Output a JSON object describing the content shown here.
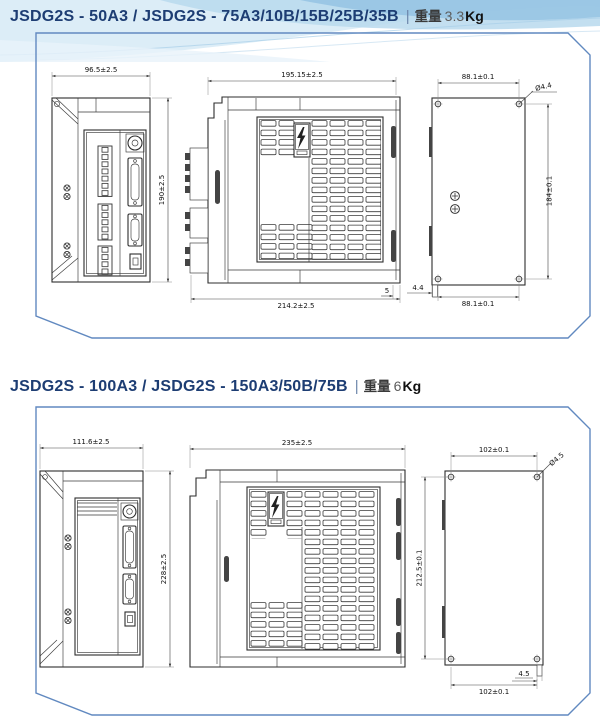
{
  "s1": {
    "title": "JSDG2S - 50A3 / JSDG2S - 75A3/10B/15B/25B/35B",
    "separator": "|",
    "weight_label": "重量",
    "weight_value": "3.3",
    "weight_unit": "Kg",
    "dims": {
      "front_width": "96.5±2.5",
      "front_height": "190±2.5",
      "side_width_top": "195.15±2.5",
      "side_width_bottom": "214.2±2.5",
      "side_edge_gap": "5",
      "back_pitch_top": "88.1±0.1",
      "back_hole_dia": "Ø4.4",
      "back_pitch_height": "184±0.1",
      "back_pitch_bottom": "88.1±0.1",
      "back_tab_width": "4.4"
    }
  },
  "s2": {
    "title": "JSDG2S - 100A3 / JSDG2S - 150A3/50B/75B",
    "separator": "|",
    "weight_label": "重量",
    "weight_value": "6",
    "weight_unit": "Kg",
    "dims": {
      "front_width": "111.6±2.5",
      "front_height": "228±2.5",
      "side_width_top": "235±2.5",
      "back_pitch_top": "102±0.1",
      "back_hole_dia": "Ø4.5",
      "back_pitch_height": "212.5±0.1",
      "back_pitch_bottom": "102±0.1",
      "back_tab_width": "4.5"
    }
  }
}
